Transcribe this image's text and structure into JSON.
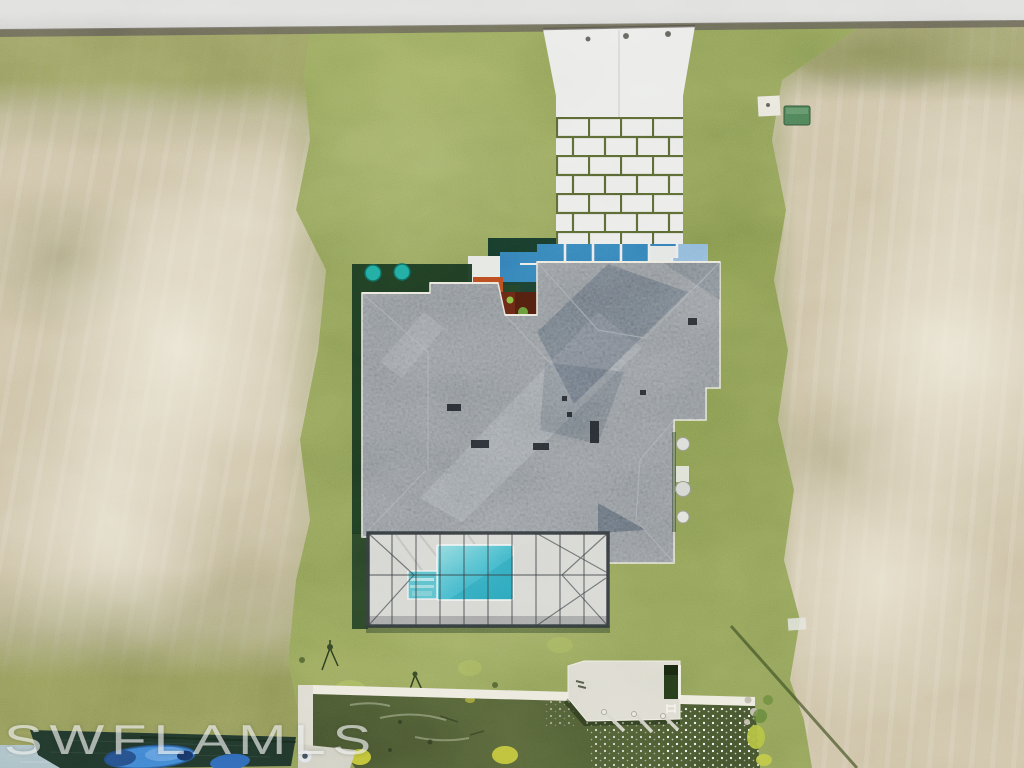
{
  "watermark": {
    "text": "SWFLAMLS"
  },
  "scene": {
    "regions": [
      "road",
      "left-vacant-lot",
      "right-vacant-lot",
      "front-lawn",
      "concrete-driveway",
      "paver-driveway-section",
      "entry-courtyard-panels",
      "landscaping-mulch-bed",
      "shingle-house-roof",
      "screened-pool-enclosure",
      "swimming-pool",
      "spa-steps",
      "backyard-lawn",
      "concrete-seawall",
      "concrete-boat-dock",
      "canal-water",
      "neighbor-dock-with-covered-boat",
      "utility-box",
      "ac-equipment"
    ]
  },
  "colors": {
    "road": "#c9c9c6",
    "road_light": "#dcdcda",
    "curb": "#5b574e",
    "lawn": "#82944f",
    "lawn_light": "#aab85f",
    "dirt": "#c8bb9c",
    "dirt_light": "#ece6d4",
    "roof": "#687078",
    "roof_light": "#9aa2aa",
    "roof_dark": "#454d57",
    "fascia": "#ece9dc",
    "driveway": "#e8e9e6",
    "joint": "#4f5c2d",
    "panel_blue": "#2f72ad",
    "panel_light": "#84b2d6",
    "glass_dark": "#153426",
    "hedge": "#16301c",
    "teal_shrub": "#1d9c90",
    "mulch": "#5e2413",
    "mulch_bright": "#b0441d",
    "plant": "#4e7a2e",
    "deck": "#d2d2cd",
    "cage": "#31373a",
    "pool_light": "#7fd4da",
    "pool_deep": "#2b9fb8",
    "spa": "#53b9c6",
    "seawall": "#eae7da",
    "concrete": "#d9d6ca",
    "canal": "#49542f",
    "canal_dark": "#3a4727",
    "algae": "#c6c835",
    "dock": "#d9d7cb",
    "dock_well": "#233618",
    "dock_dark": "#1d3026",
    "corner_water": "#9cb6bd",
    "boat": "#3a78cc",
    "boat_dark": "#1f3f6e",
    "fender": "#dde2e6",
    "utility": "#45714d",
    "equipment": "#d8d9d3",
    "shadow": "#3c4824",
    "watermark": "rgba(255,255,255,0.62)"
  }
}
